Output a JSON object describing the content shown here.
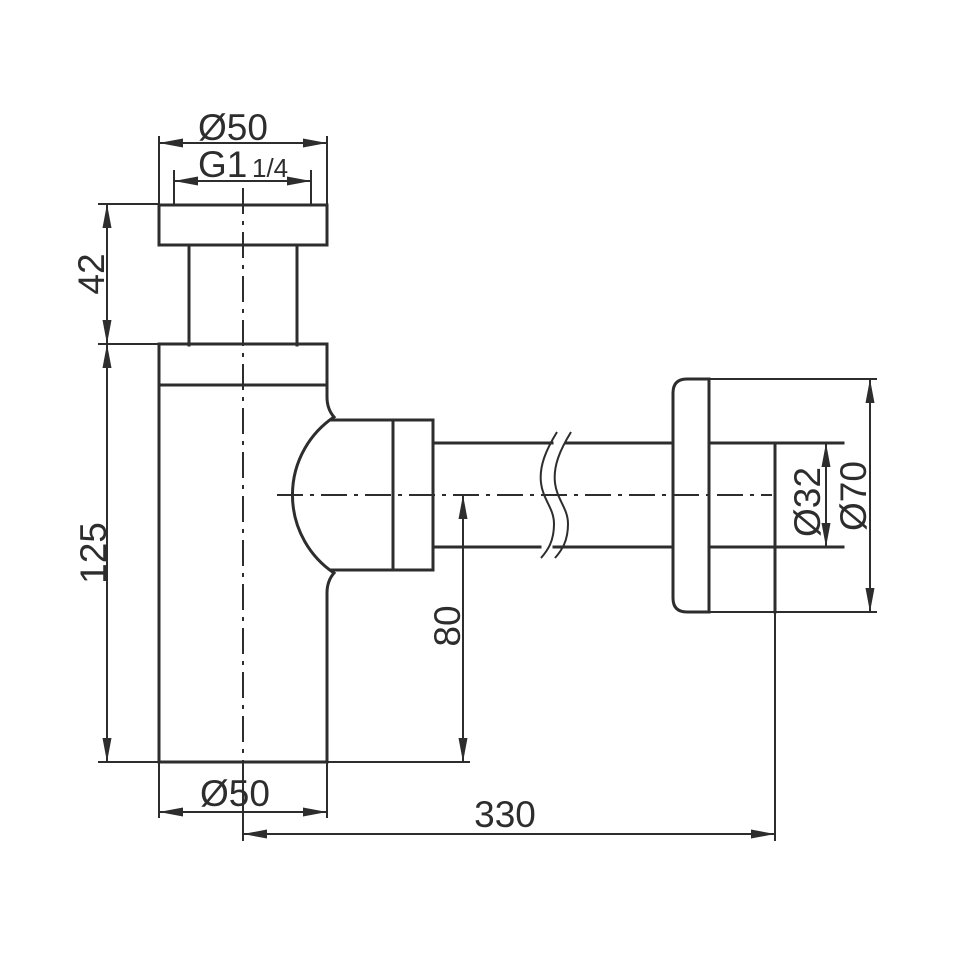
{
  "dimensions": {
    "top_diameter": "Ø50",
    "thread_size": "G1",
    "thread_fraction": "1/4",
    "upper_height": "42",
    "body_height": "125",
    "outlet_center_height": "80",
    "bottom_diameter": "Ø50",
    "overall_length": "330",
    "pipe_diameter": "Ø32",
    "flange_diameter": "Ø70"
  },
  "colors": {
    "line_color": "#2d2d2d",
    "background": "#ffffff"
  }
}
